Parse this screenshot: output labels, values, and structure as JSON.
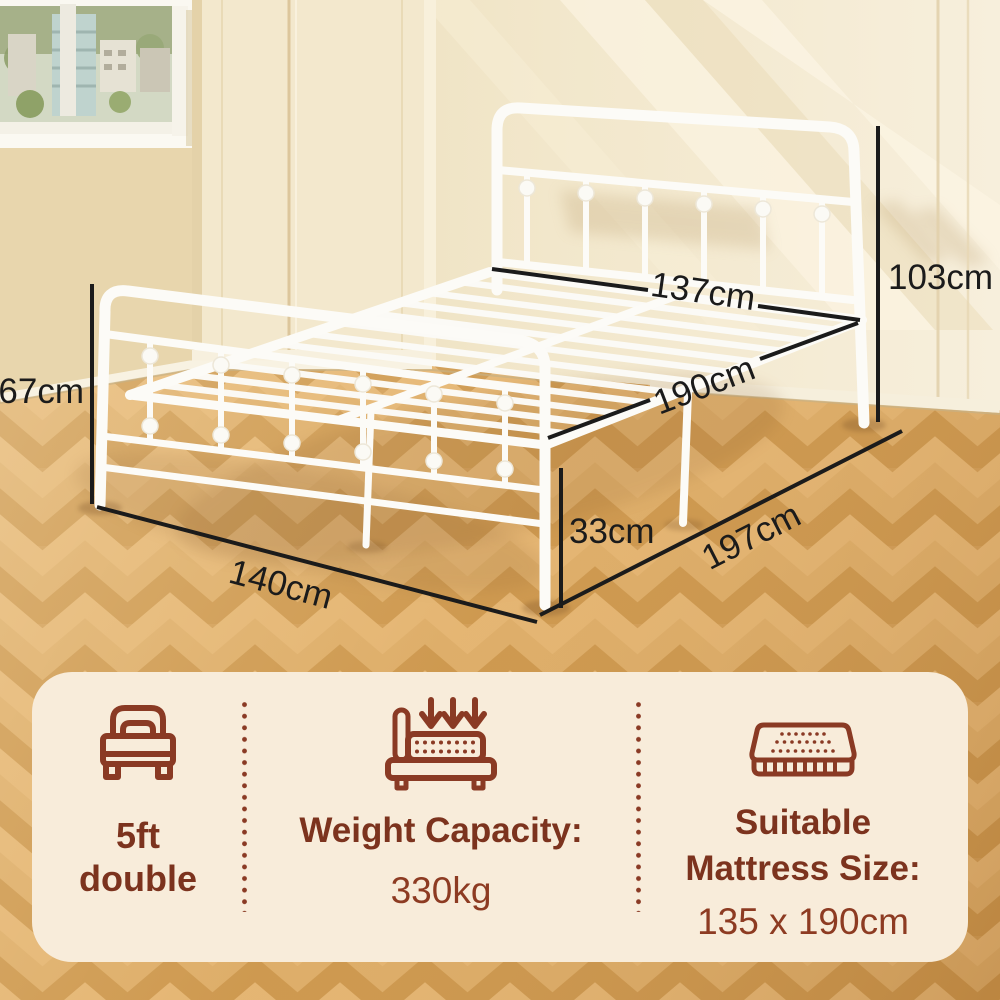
{
  "scene": {
    "dimensions": {
      "width_top": "137cm",
      "headboard_height": "103cm",
      "footboard_height": "67cm",
      "length_top": "190cm",
      "base_height": "33cm",
      "length_floor": "197cm",
      "width_floor": "140cm"
    }
  },
  "panel": {
    "size": {
      "icon": "single-bed-icon",
      "line1": "5ft",
      "line2": "double"
    },
    "weight": {
      "icon": "weight-capacity-icon",
      "title": "Weight Capacity:",
      "value": "330kg"
    },
    "mattress": {
      "icon": "mattress-icon",
      "title": "Suitable Mattress Size:",
      "value": "135 x 190cm"
    }
  },
  "colors": {
    "accent_brown": "#8A3A24",
    "heading_brown": "#7C331E",
    "dimension_text": "#1B1B1B",
    "panel_bg": "#F8ECDA",
    "bed_white": "#FCFBF7",
    "wall_beige": "#F0E4C8",
    "floor_wood": "#D4A058"
  }
}
